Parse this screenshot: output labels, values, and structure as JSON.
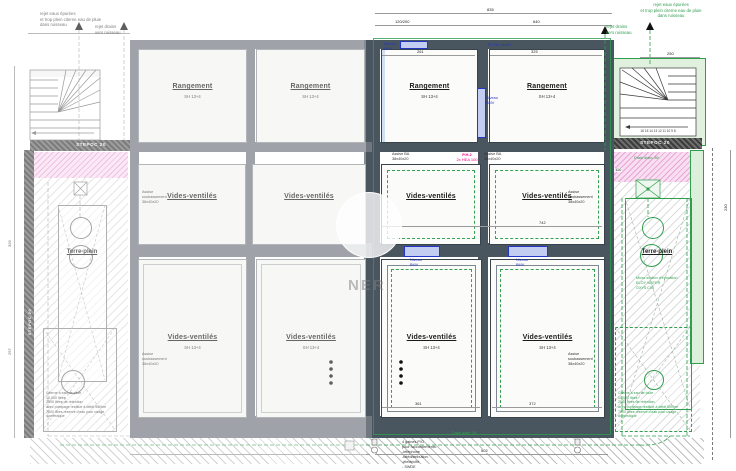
{
  "plan": {
    "type": "foundation-and-crawlspace-plan",
    "watermark": "NER"
  },
  "colors": {
    "wall_gray": "#70777f",
    "wall_dark": "#49555f",
    "green": "#2f9e4e",
    "green_light": "#dcefdb",
    "pink_hatch": "#f9def1",
    "blue": "#2336c6",
    "blue_fill": "#c3cdf2",
    "magenta": "#e6007e"
  },
  "notes": {
    "top_left": "rejet eaux épurées\net trop plein citerne eau de pluie\ndans ruisseau",
    "top_left_drain": "rejet drains\nvers ruisseau",
    "top_right": "rejet eaux épurées\net trop plein citerne eau de pluie\ndans ruisseau",
    "top_right_drain": "rejet drains\nvers ruisseau"
  },
  "rooms": {
    "r1a": {
      "label": "Rangement",
      "sub": "SH 13+4"
    },
    "r1b": {
      "label": "Rangement",
      "sub": "SH 13+4"
    },
    "r1c": {
      "label": "Rangement",
      "sub": "SH 13+4"
    },
    "r1d": {
      "label": "Rangement",
      "sub": "SH 13+4"
    },
    "r2a": {
      "label": "Vides-ventilés"
    },
    "r2b": {
      "label": "Vides-ventilés"
    },
    "r2c": {
      "label": "Vides-ventilés"
    },
    "r2d": {
      "label": "Vides-ventilés"
    },
    "r3a": {
      "label": "Vides-ventilés",
      "sub": "SH 13+4"
    },
    "r3b": {
      "label": "Vides-ventilés",
      "sub": "SH 13+4"
    },
    "r3c": {
      "label": "Vides-ventilés",
      "sub": "SH 13+4"
    },
    "r3d": {
      "label": "Vides-ventilés",
      "sub": "SH 13+4"
    },
    "terre_left": {
      "label": "Terre-plein"
    },
    "terre_right": {
      "label": "Terre-plein"
    }
  },
  "labels": {
    "stepoc": "STEPOC 20",
    "pc_ba": "PC BA 14x20",
    "niveau_bmv": "Niveau\nBMV",
    "ph2": "P.H.2",
    "hea": "2x HEA 100",
    "assise_ba": "Assise BA\n38x40x20",
    "assise_soub": "Assise\nsoubassement\n38x40x20",
    "drain": "Drain diam. 80",
    "steps": "16 15 14 13 12 11 10 9 8"
  },
  "blocks": {
    "citerne": "Citerne à eau de pluie\n10.000 litres\n2500 litres de rétention\navec pompage restitué à débit 50l/hre\n7500 litres réserve d'eau pour usage\ndomestique",
    "micro_station": "Micro-station d'épuration\nELOY WATER\nOXY5 C90",
    "gaines": "4 gaines P/O\npour raccordements:\n-téléphone\n-télédistribution\n-électricité\n- SWDE"
  },
  "dims": {
    "total_top": "835",
    "seg_a": "120/200",
    "seg_b": "640",
    "r1c_w": "261",
    "r1d_w": "325",
    "mid_w": "742",
    "r3c_w": "361",
    "r3d_w": "372",
    "stair_w": "250",
    "bottom_w": "502",
    "right_h": "230",
    "left_h1": "326",
    "left_h2": "297",
    "pink_w": "110"
  }
}
